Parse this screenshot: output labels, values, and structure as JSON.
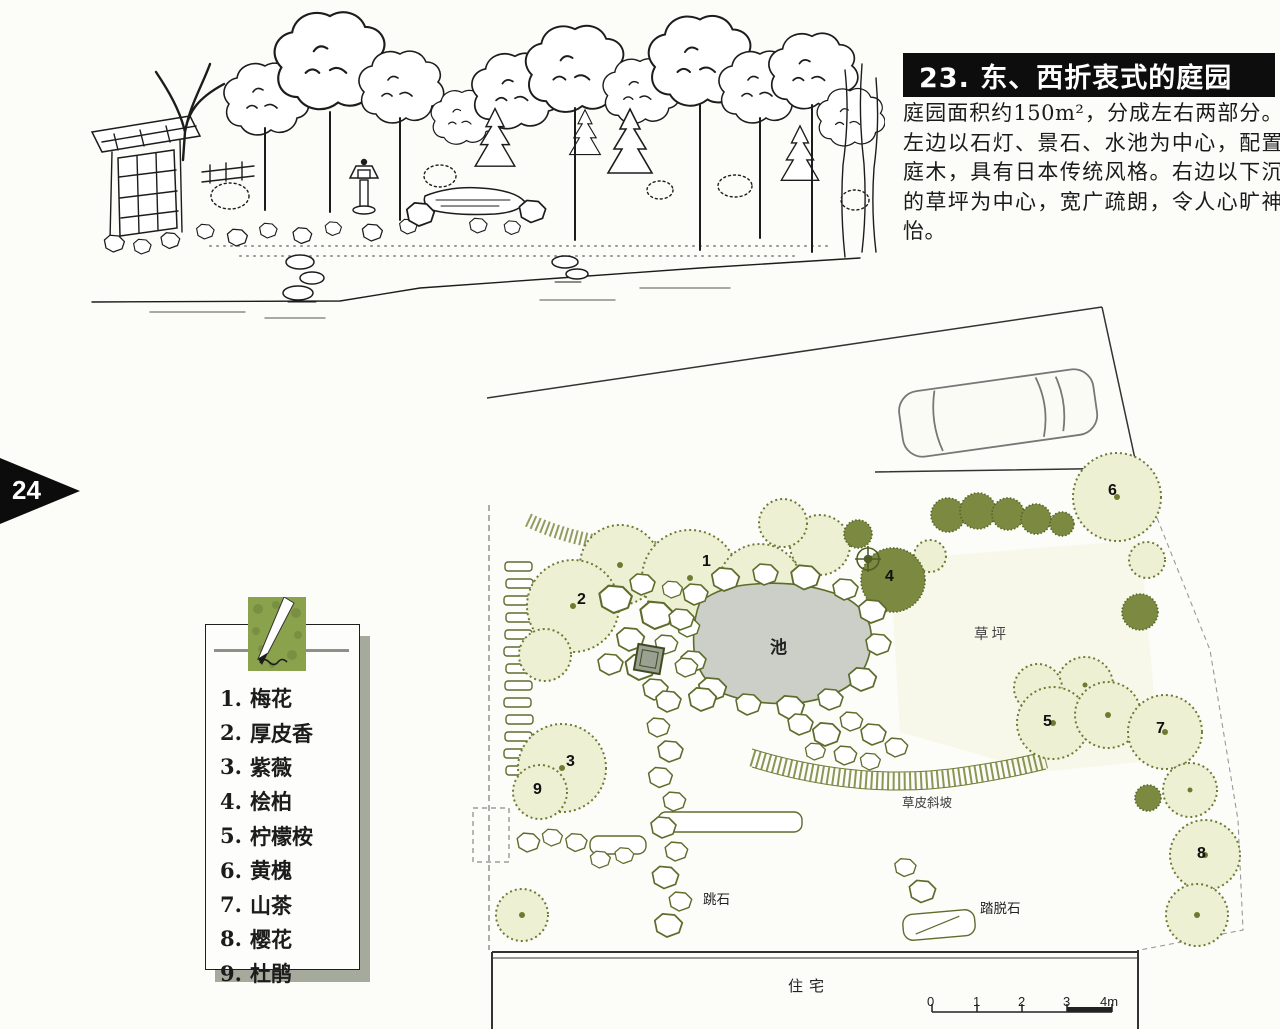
{
  "page_number": "24",
  "header": {
    "title": "23. 东、西折衷式的庭园"
  },
  "intro": {
    "text": "庭园面积约150m²，分成左右两部分。左边以石灯、景石、水池为中心，配置庭木，具有日本传统风格。右边以下沉的草坪为中心，宽广疏朗，令人心旷神怡。"
  },
  "legend": {
    "icon": "pen-drawing-icon",
    "items": [
      {
        "num": "1.",
        "name": "梅花"
      },
      {
        "num": "2.",
        "name": "厚皮香"
      },
      {
        "num": "3.",
        "name": "紫薇"
      },
      {
        "num": "4.",
        "name": "桧柏"
      },
      {
        "num": "5.",
        "name": "柠檬桉"
      },
      {
        "num": "6.",
        "name": "黄槐"
      },
      {
        "num": "7.",
        "name": "山茶"
      },
      {
        "num": "8.",
        "name": "樱花"
      },
      {
        "num": "9.",
        "name": "杜鹃"
      }
    ]
  },
  "plan": {
    "labels": {
      "pond": "池",
      "lawn": "草坪",
      "turf_slope": "草皮斜坡",
      "stepping_stones": "跳石",
      "shoe_stone": "踏脱石",
      "residence": "住宅"
    },
    "markers": [
      "1",
      "2",
      "3",
      "4",
      "5",
      "6",
      "7",
      "8",
      "9"
    ],
    "scale_ticks": [
      "0",
      "1",
      "2",
      "3",
      "4m"
    ]
  },
  "colors": {
    "banner_bg": "#0d0d0d",
    "plan_line": "#6d7b31",
    "legend_green": "#8ba24d",
    "pond_fill": "#cbcfc7"
  }
}
